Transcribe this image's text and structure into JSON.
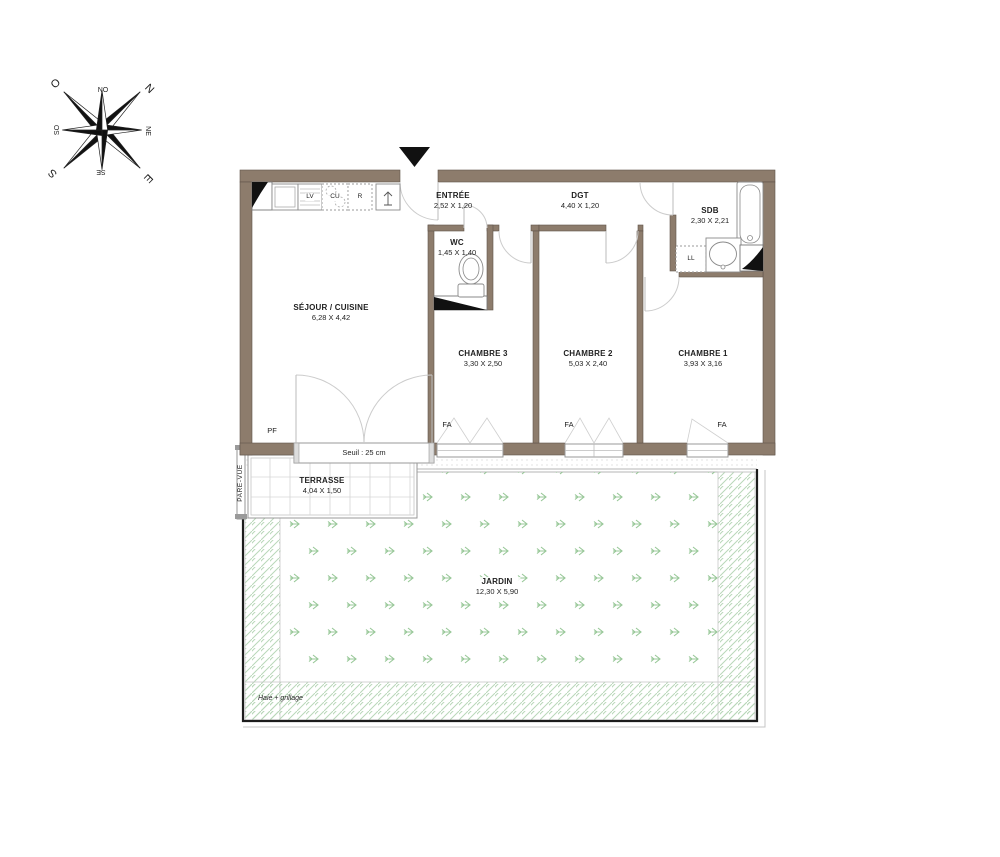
{
  "compass": {
    "n": "N",
    "ne": "NE",
    "e": "E",
    "se": "SE",
    "s": "S",
    "so": "SO",
    "o": "O",
    "no": "NO"
  },
  "rooms": {
    "sejour": {
      "name": "SÉJOUR / CUISINE",
      "dims": "6,28 X 4,42"
    },
    "entree": {
      "name": "ENTRÉE",
      "dims": "2,52 X 1,20"
    },
    "wc": {
      "name": "WC",
      "dims": "1,45 X 1,40"
    },
    "dgt": {
      "name": "DGT",
      "dims": "4,40 X 1,20"
    },
    "sdb": {
      "name": "SDB",
      "dims": "2,30 X 2,21"
    },
    "chambre3": {
      "name": "CHAMBRE 3",
      "dims": "3,30 X 2,50"
    },
    "chambre2": {
      "name": "CHAMBRE 2",
      "dims": "5,03 X 2,40"
    },
    "chambre1": {
      "name": "CHAMBRE 1",
      "dims": "3,93 X 3,16"
    },
    "terrasse": {
      "name": "TERRASSE",
      "dims": "4,04 X 1,50"
    },
    "jardin": {
      "name": "JARDIN",
      "dims": "12,30 X 5,90"
    }
  },
  "appliances": {
    "dishwasher": "LV",
    "cooktop": "CU",
    "fridge": "R",
    "washer": "LL"
  },
  "openings": {
    "french_door_label": "PF",
    "window_label": "FA",
    "threshold": "Seuil : 25 cm"
  },
  "annotations": {
    "screen": "PARE-VUE",
    "hedge": "Haie + grillage"
  },
  "colors": {
    "wall": "#8d7c6c",
    "grass": "#97c797",
    "hatch": "#b9d8b9",
    "boundary": "#1c1c1c"
  }
}
